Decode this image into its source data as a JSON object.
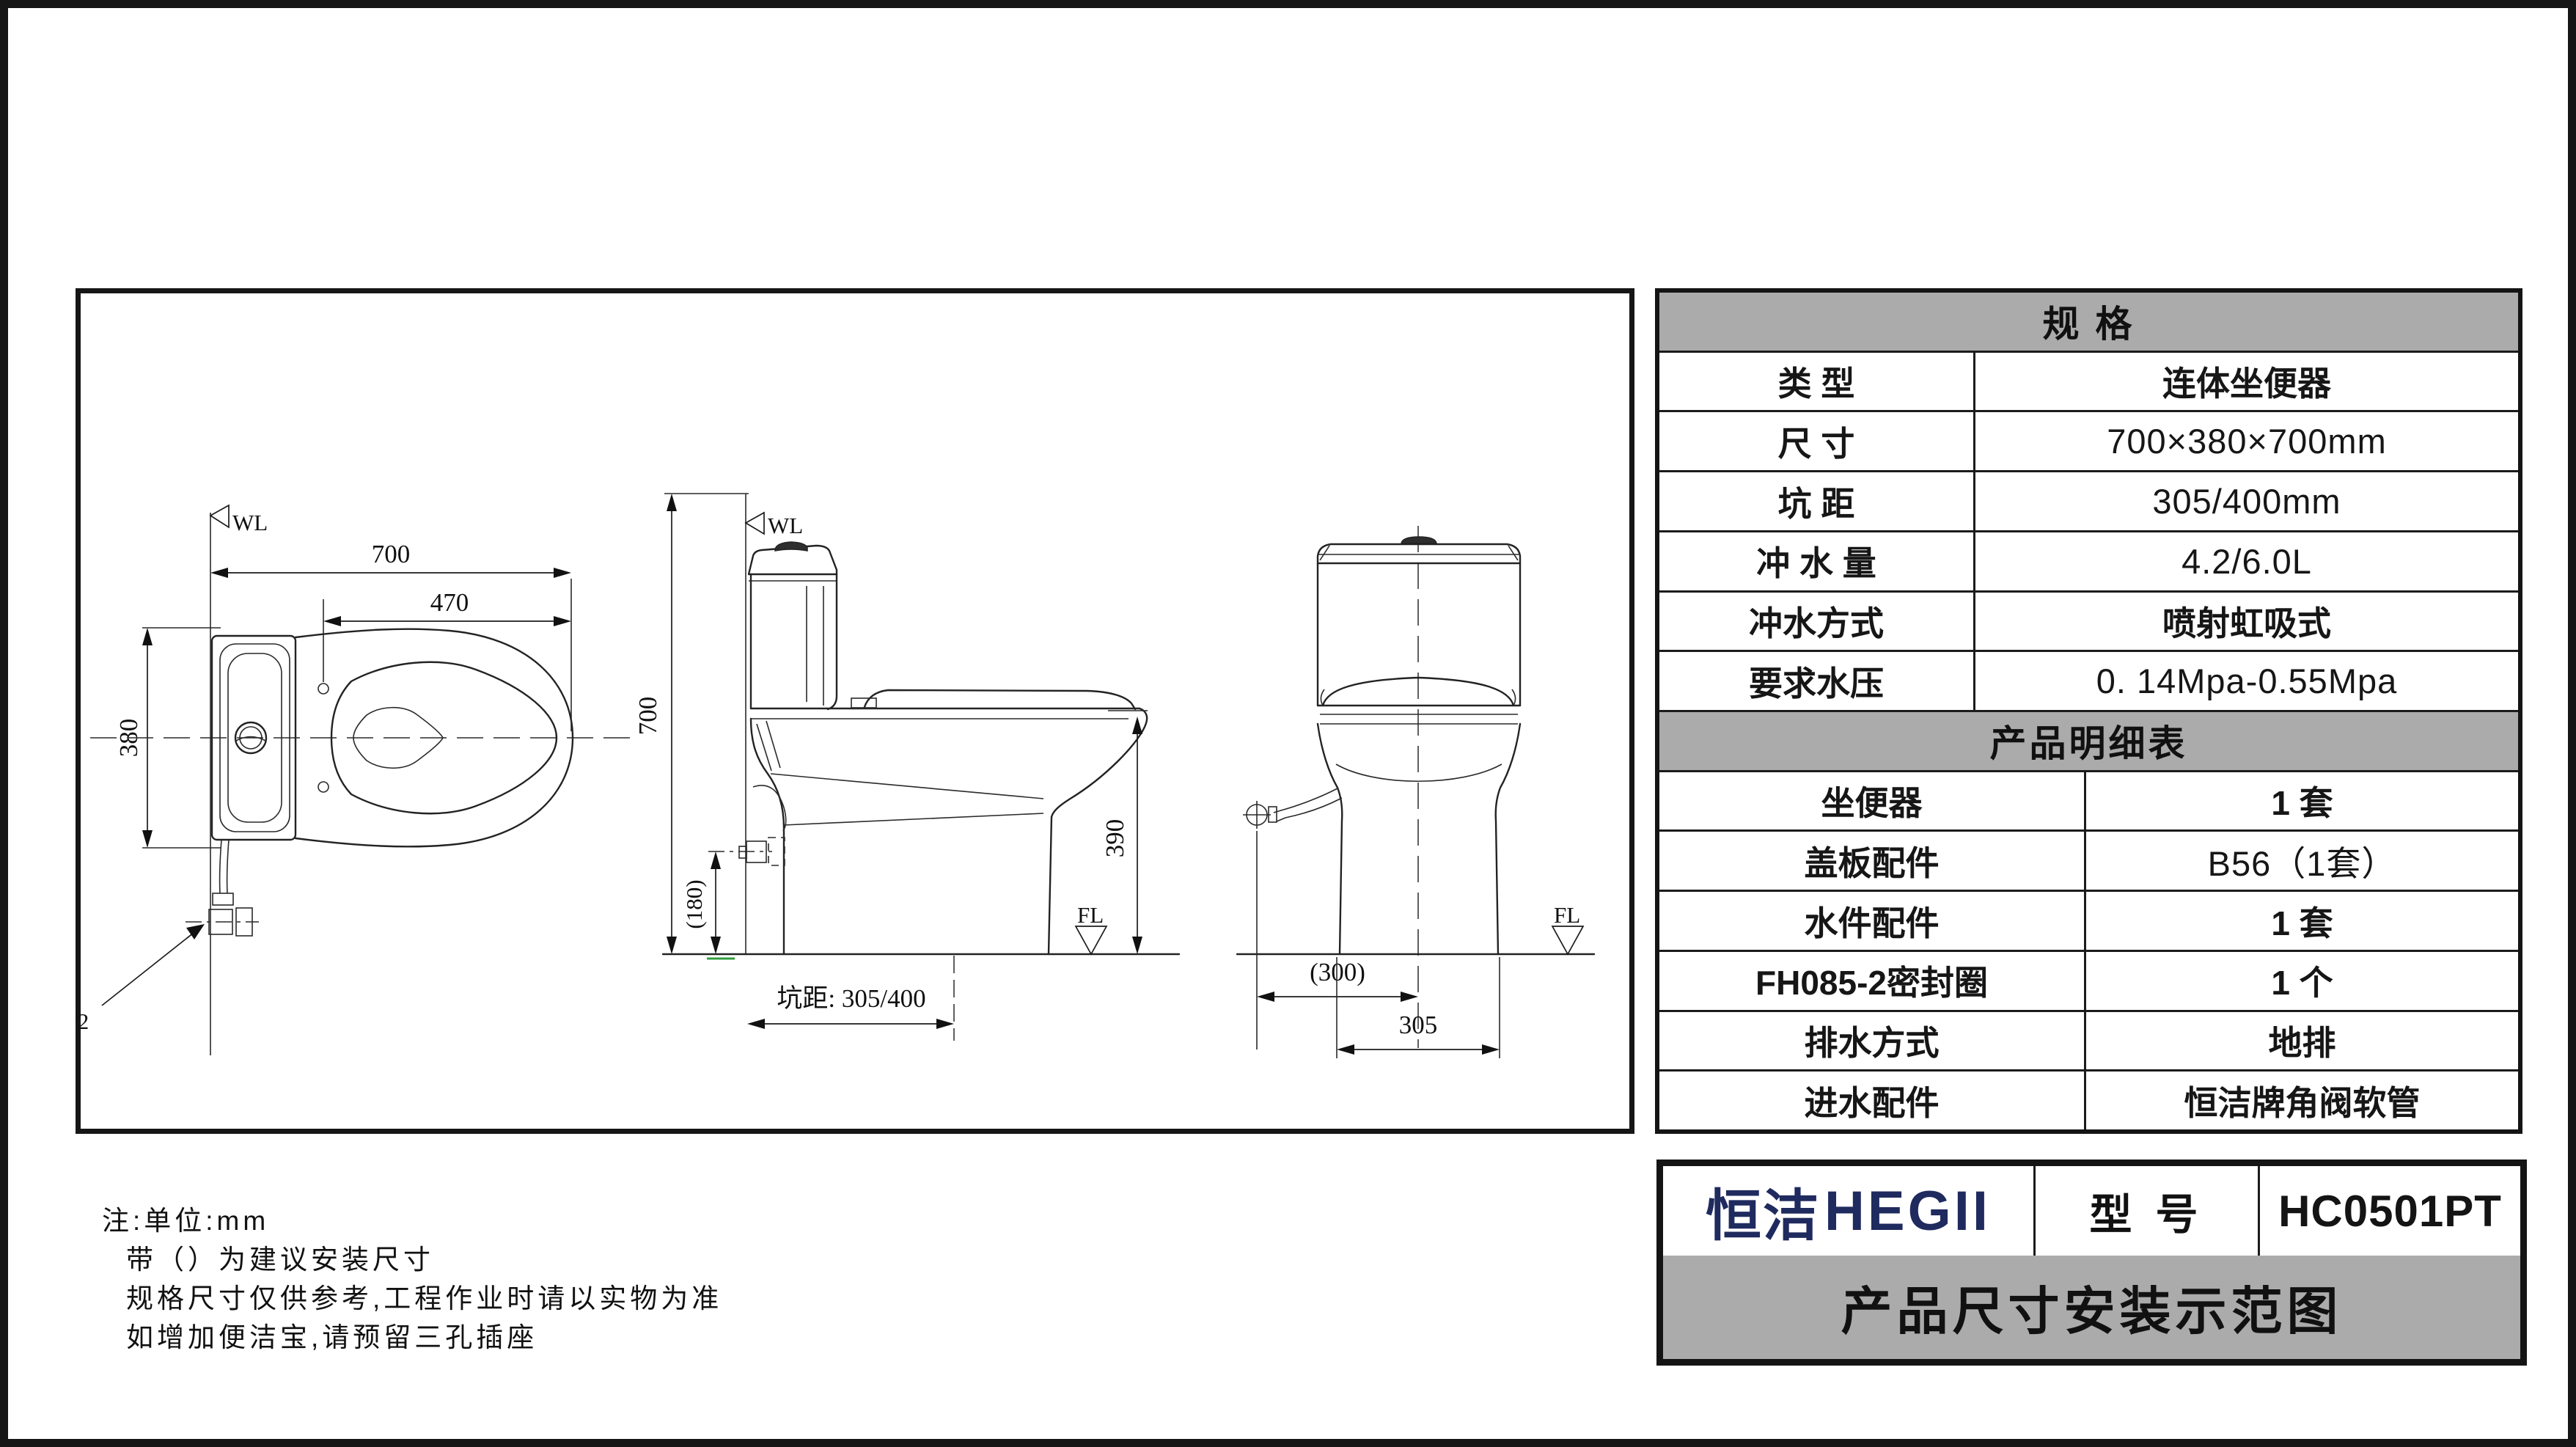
{
  "page": {
    "bg_color": "#ffffff",
    "border_color": "#161616",
    "header_bg": "#ababab"
  },
  "drawing": {
    "top_view": {
      "wl_label": "WL",
      "dim_overall_length": "700",
      "dim_hole_to_front": "470",
      "dim_width": "380",
      "inlet_thread_label": "R1/2"
    },
    "side_view": {
      "wl_label": "WL",
      "fl_label": "FL",
      "dim_overall_height": "700",
      "dim_rim_height": "390",
      "dim_valve_height": "(180)",
      "pit_distance_label": "坑距: 305/400"
    },
    "front_view": {
      "fl_label": "FL",
      "dim_valve_offset": "(300)",
      "dim_base_width": "305"
    }
  },
  "spec_table": {
    "title": "规  格",
    "rows": [
      {
        "label": "类  型",
        "value": "连体坐便器"
      },
      {
        "label": "尺  寸",
        "value": "700×380×700mm"
      },
      {
        "label": "坑  距",
        "value": "305/400mm"
      },
      {
        "label": "冲 水 量",
        "value": "4.2/6.0L"
      },
      {
        "label": "冲水方式",
        "value": "喷射虹吸式"
      },
      {
        "label": "要求水压",
        "value": "0. 14Mpa-0.55Mpa"
      }
    ]
  },
  "product_table": {
    "title": "产品明细表",
    "rows": [
      {
        "label": "坐便器",
        "value": "1 套"
      },
      {
        "label": "盖板配件",
        "value": "B56（1套）"
      },
      {
        "label": "水件配件",
        "value": "1 套"
      },
      {
        "label": "FH085-2密封圈",
        "value": "1 个"
      },
      {
        "label": "排水方式",
        "value": "地排"
      },
      {
        "label": "进水配件",
        "value": "恒洁牌角阀软管"
      }
    ]
  },
  "title_block": {
    "brand_cn": "恒洁",
    "brand_en": "HEGII",
    "brand_color": "#1f2b5e",
    "model_label": "型 号",
    "model_value": "HC0501PT",
    "caption": "产品尺寸安装示范图"
  },
  "notes": {
    "lines": [
      "注:单位:mm",
      "带（）为建议安装尺寸",
      "规格尺寸仅供参考,工程作业时请以实物为准",
      "如增加便洁宝,请预留三孔插座"
    ]
  }
}
